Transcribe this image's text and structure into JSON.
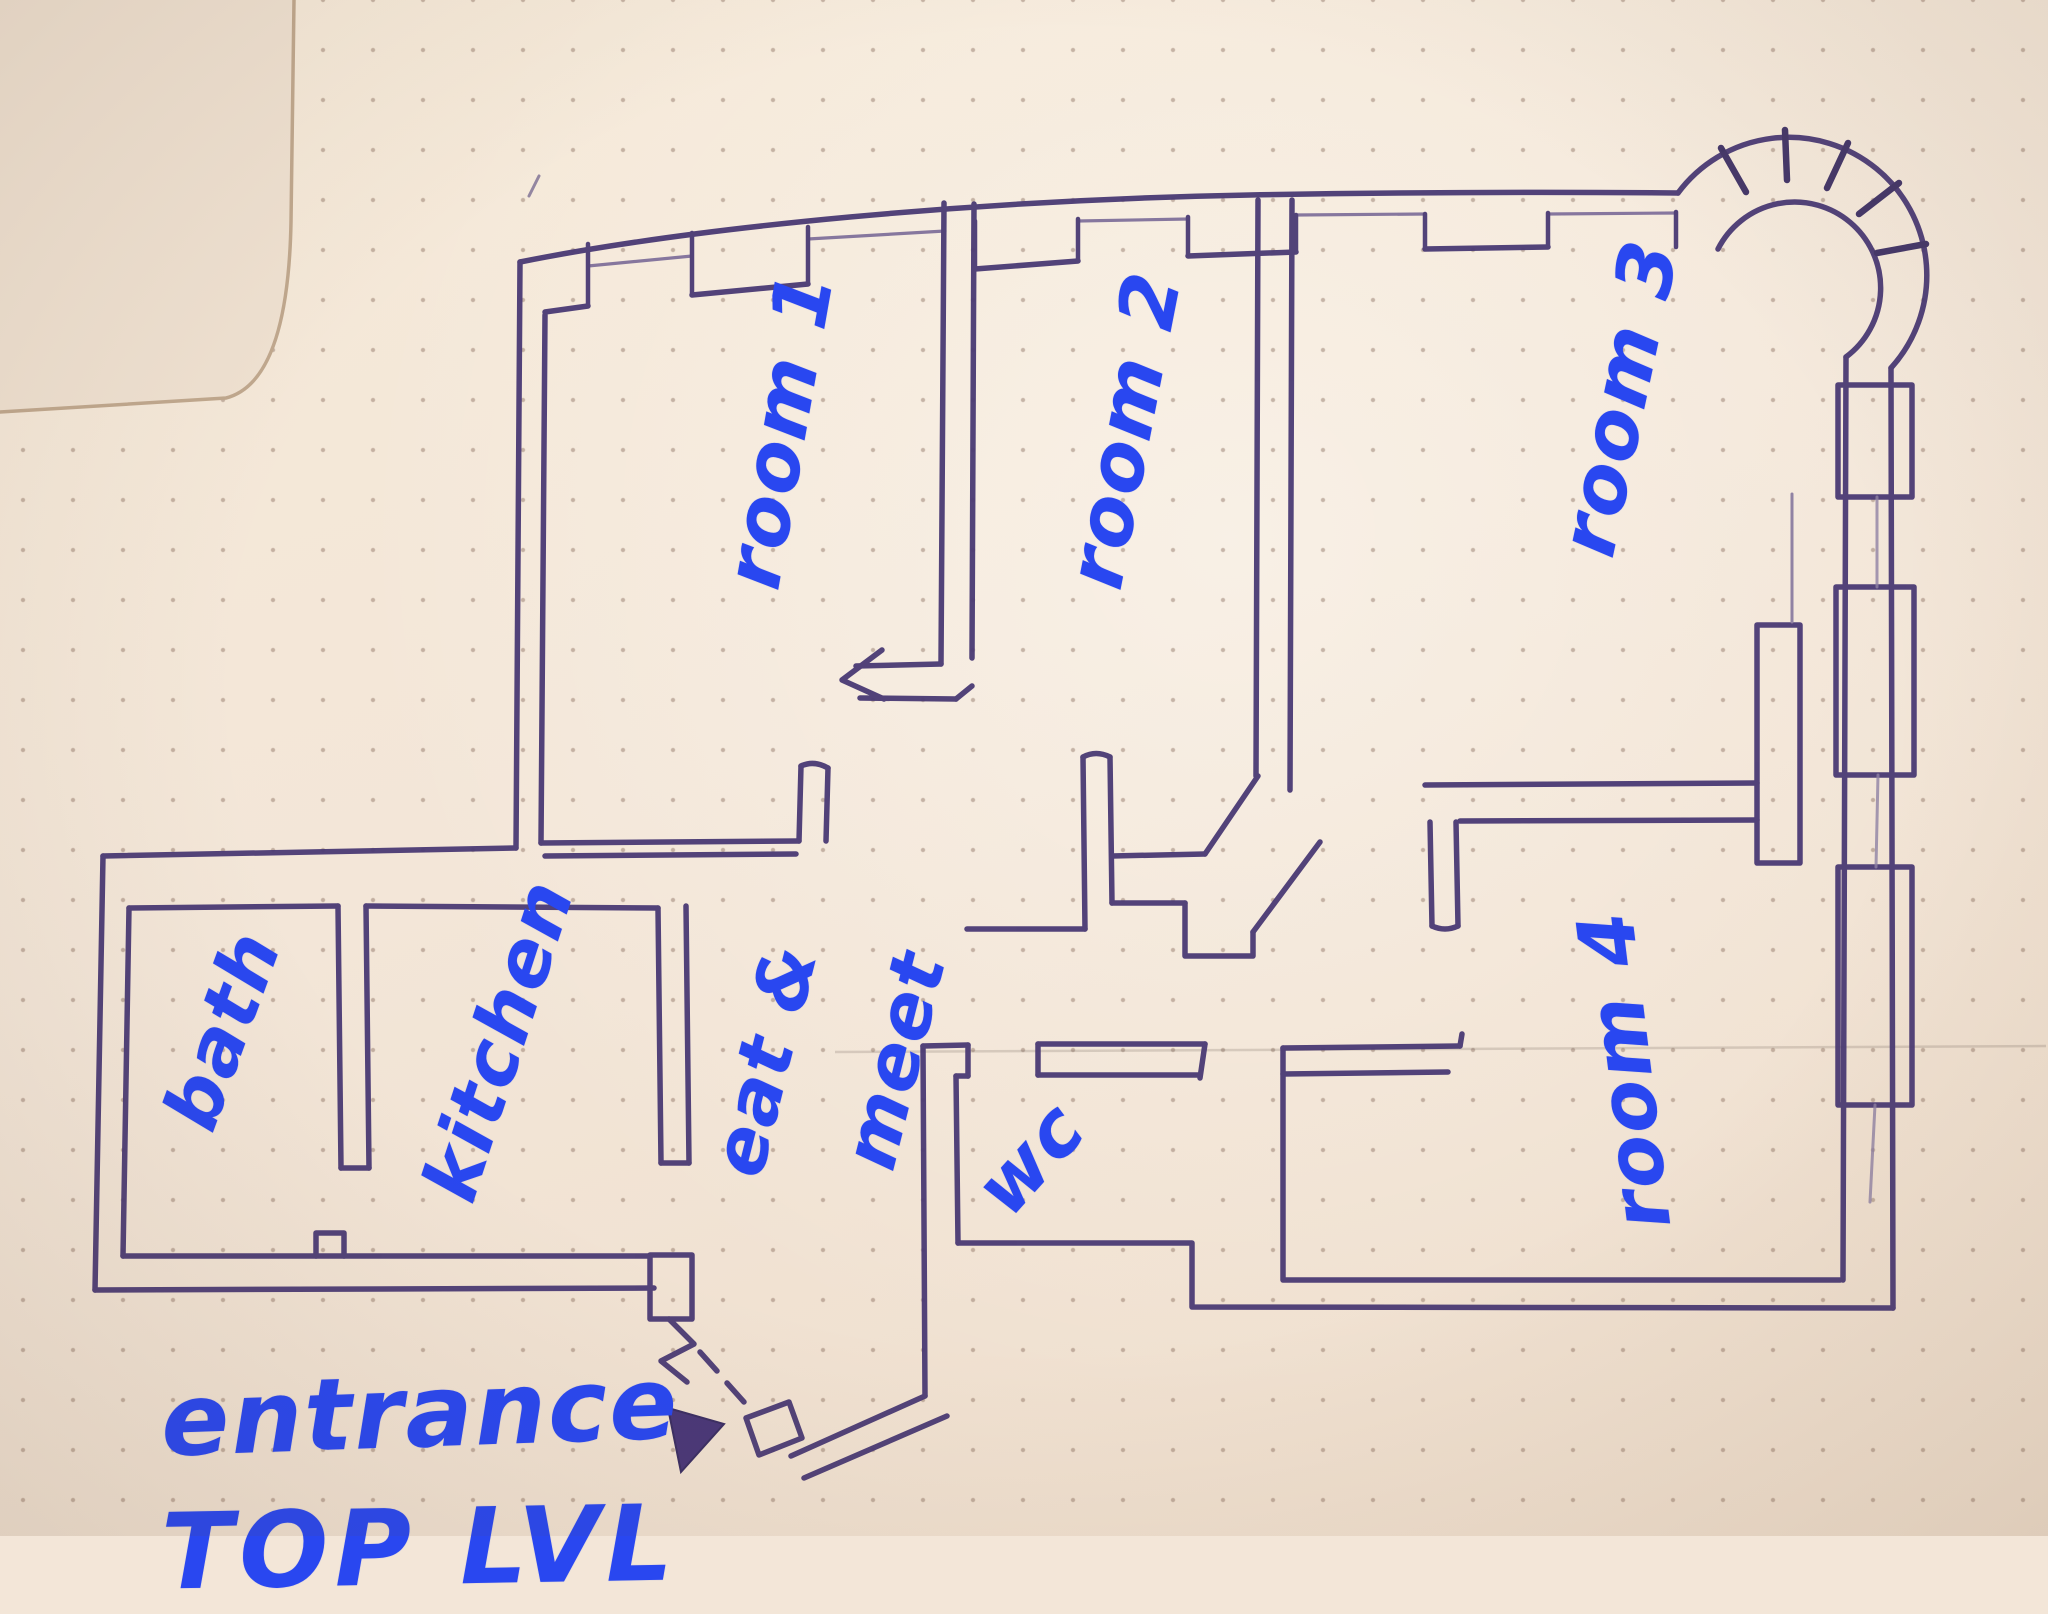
{
  "colors": {
    "paper": "#f3e6d8",
    "ink": "#4a3a74",
    "ink_dark": "#3c2f63",
    "label_blue": "#2947f0",
    "under_page_edge": "#c0a88e"
  },
  "labels": {
    "room1": "room 1",
    "room2": "room 2",
    "room3": "room 3",
    "room4": "room 4",
    "bath": "bath",
    "kitchen": "kitchen",
    "eat_and": "eat &",
    "meet": "meet",
    "wc": "wc",
    "entrance": "entrance",
    "level": "TOP LVL"
  }
}
